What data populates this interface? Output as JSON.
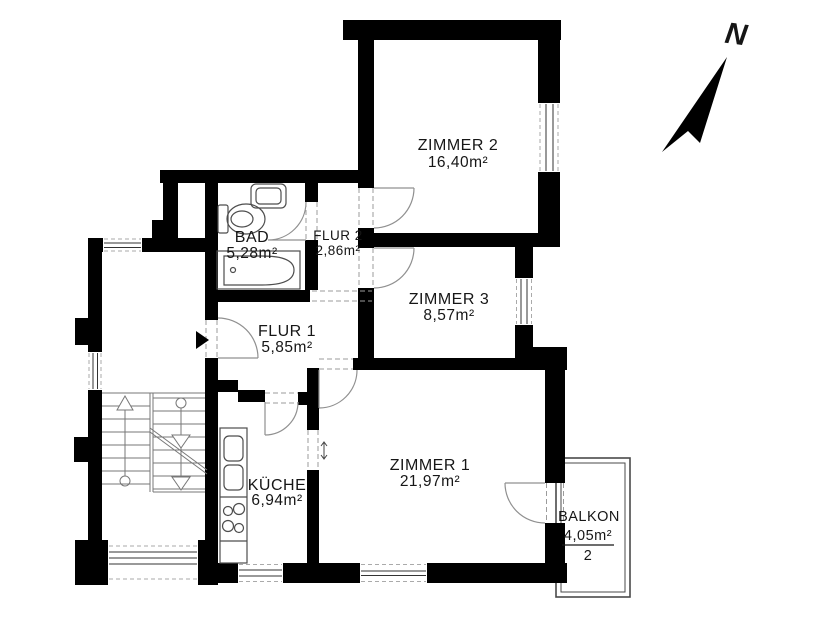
{
  "plan": {
    "rooms": {
      "zimmer2": {
        "name": "ZIMMER 2",
        "area": "16,40m²"
      },
      "zimmer3": {
        "name": "ZIMMER 3",
        "area": "8,57m²"
      },
      "zimmer1": {
        "name": "ZIMMER 1",
        "area": "21,97m²"
      },
      "bad": {
        "name": "BAD",
        "area": "5,28m²"
      },
      "flur1": {
        "name": "FLUR 1",
        "area": "5,85m²"
      },
      "flur2": {
        "name": "FLUR 2",
        "area": "2,86m²"
      },
      "kueche": {
        "name": "KÜCHE",
        "area": "6,94m²"
      },
      "balkon": {
        "name": "BALKON",
        "area": "4,05m²",
        "area_divisor": "2"
      }
    },
    "compass": {
      "north_label": "N"
    },
    "colors": {
      "wall": "#000000",
      "fixture_line": "#4d4d4d",
      "door_arc": "#909090",
      "background": "#ffffff"
    }
  }
}
